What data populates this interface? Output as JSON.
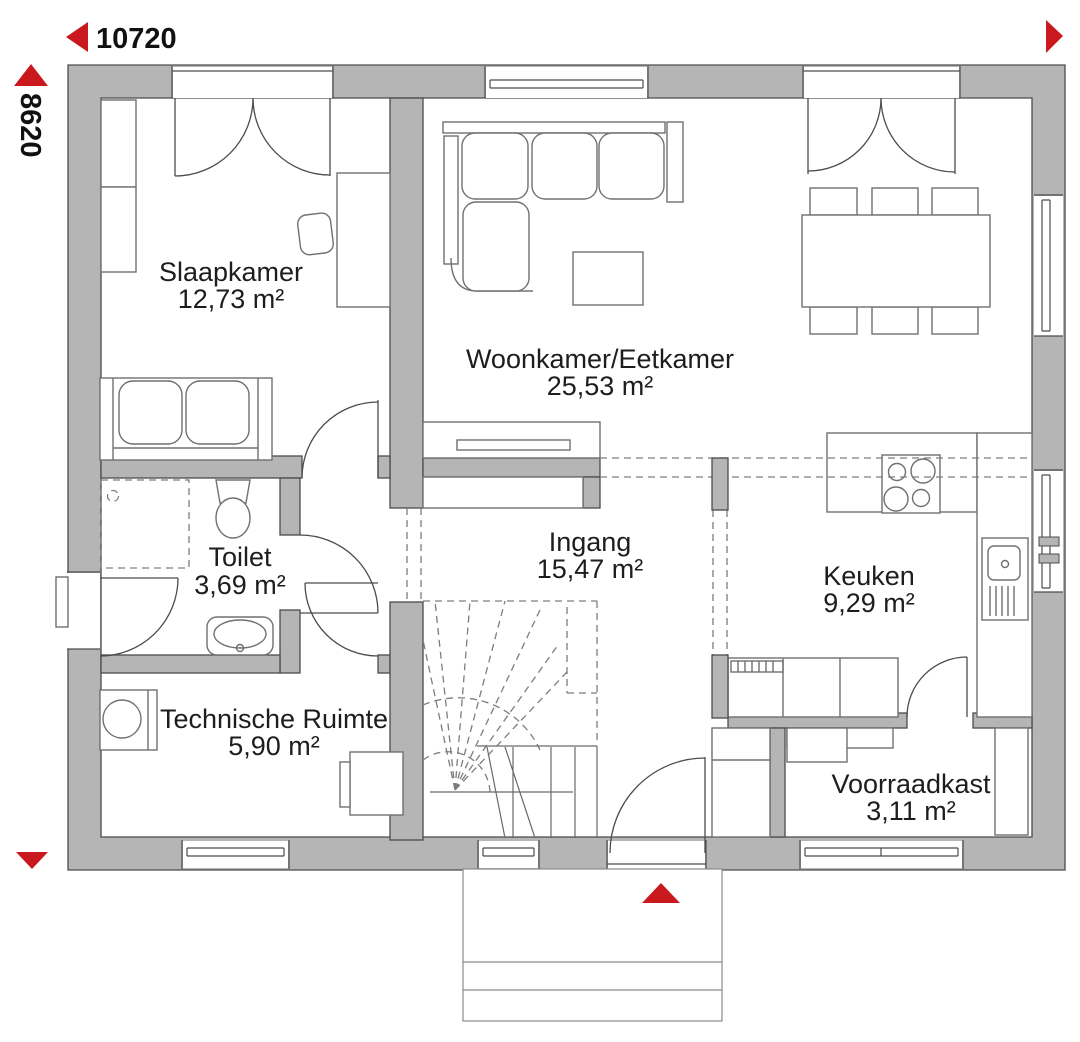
{
  "dimensions": {
    "width": "10720",
    "height": "8620"
  },
  "rooms": [
    {
      "name": "Slaapkamer",
      "area": "12,73 m²"
    },
    {
      "name": "Woonkamer/Eetkamer",
      "area": "25,53 m²"
    },
    {
      "name": "Toilet",
      "area": "3,69 m²"
    },
    {
      "name": "Ingang",
      "area": "15,47 m²"
    },
    {
      "name": "Keuken",
      "area": "9,29 m²"
    },
    {
      "name": "Technische Ruimte",
      "area": "5,90 m²"
    },
    {
      "name": "Voorraadkast",
      "area": "3,11 m²"
    }
  ],
  "colors": {
    "wall": "#b5b5b5",
    "wall_outline": "#4c4c4c",
    "furniture_outline": "#707070",
    "dashed_line": "#7d7d7d",
    "accent_red": "#c9191e",
    "text": "#1d1d1b"
  }
}
